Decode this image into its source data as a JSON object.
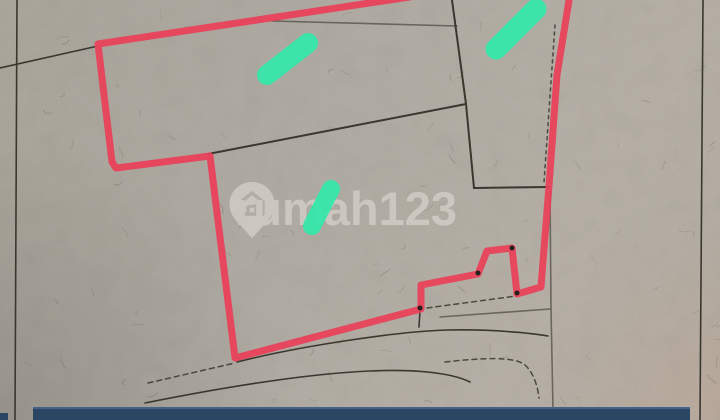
{
  "watermark": {
    "text": "rumah123",
    "icon": "location-pin-house-icon"
  },
  "colors": {
    "paper": "#b3aea5",
    "ink": "#3a372f",
    "red": "#ea3f58",
    "green": "#36e7ab",
    "navy": "#2b4663",
    "navytop": "#44628a",
    "watermark": "#d2cec6"
  },
  "plan": {
    "red_outline": "M416,-4 L98,44 L112,162 L116,168 L210,156 L235,358 L421,309 L421,285 L478,274 L487,251 L512,248 L517,294 L541,287 L549,186 L557,75 L570,-6",
    "corner_markers": "M478,273 l0.01,0 M512,248 l0.01,0 M517,293 l0.01,0 M420,308 l0.01,0",
    "capsules": [
      "M267,75 L308,43",
      "M496,49 L536,9",
      "M312,226 L331,189"
    ],
    "boundaries": {
      "left": "M17,0 L15,420",
      "right": "M703,0 L700,420",
      "top_left_diagonal": "M0,68 L98,46",
      "top_middle": "M272,21 L457,26",
      "from_top": "M452,0 L466,104 L474,188 L549,187",
      "middle_diagonal": "M208,154 L466,104",
      "right_lower": "M550,190 L551,308 L553,410",
      "under_plot": "M237,362 C300,346 400,331 448,330 C490,329 530,333 548,336",
      "right_short": "M440,317 L550,309",
      "notch_tick": "M420,310 L419,327"
    },
    "dashed": {
      "along_right_edge": "M555,25 L544,182",
      "below_plot": "M427,308 L516,296",
      "road_left": "M148,383 L235,363",
      "road_curve": "M445,362 C480,358 515,356 525,365 C534,373 538,388 539,398"
    },
    "road_solid": "M145,403 C210,390 300,374 370,371 C410,369 450,372 470,382"
  }
}
